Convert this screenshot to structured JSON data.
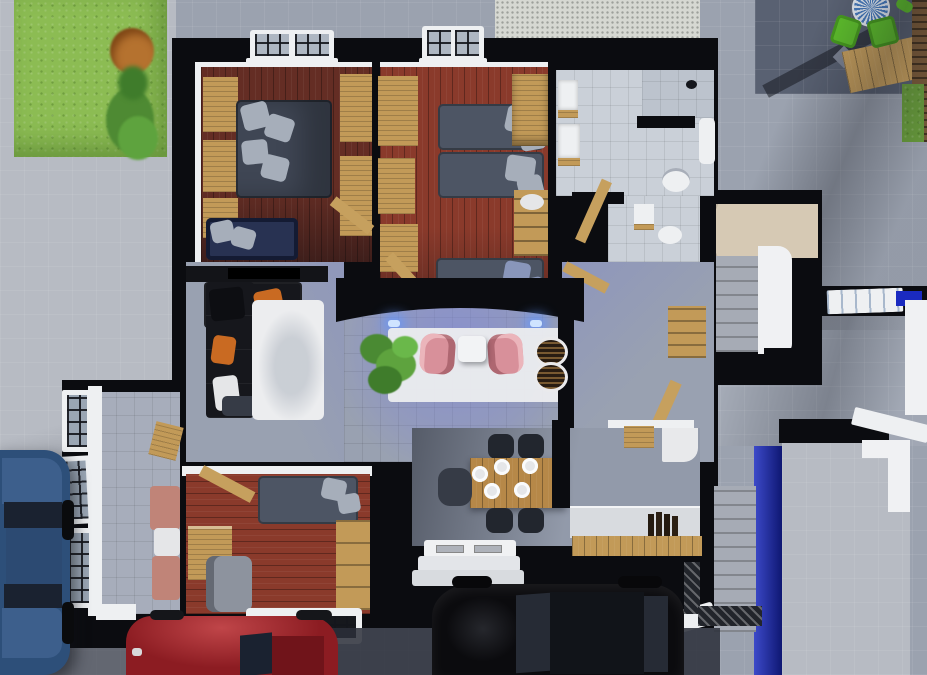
{
  "scene": {
    "kind": "3d-architectural-floor-plan-render",
    "view": "top-down",
    "rooms": [
      "bedroom-top-left",
      "bedroom-top-center",
      "bathroom-main",
      "bathroom-small",
      "hallway",
      "stair-hall",
      "living-room",
      "lounge",
      "sitting-wing",
      "bedroom-bottom",
      "dining-kitchen"
    ],
    "outdoor": [
      "front-lawn",
      "garden-tree",
      "gravel-strip",
      "patio-terrace",
      "wood-deck",
      "driveway",
      "entrance-porch",
      "exterior-stairs",
      "garden-walls"
    ],
    "vehicles": [
      "blue-car",
      "red-car",
      "black-car"
    ]
  },
  "palette": {
    "ground_mid": "#9ba2af",
    "ground_light": "#b7bbc3",
    "patio_dark": "#596172",
    "grass": "#8cbc53",
    "grass_dark": "#699d3c",
    "canopy_orange": "#b5722f",
    "bush_green": "#4e8a33",
    "gravel": "#d6d8d2",
    "wall": "#0b0c10",
    "trim": "#eef0f2",
    "wood_floor_dark": "#642d24",
    "wood_floor_red": "#8a3a2b",
    "wood": "#c29a58",
    "wood_table": "#b68848",
    "door_wood": "#c6a05e",
    "tile_bath": "#cad0d8",
    "tile_shower": "#bcc3cd",
    "tile_room": "#99a1b1",
    "tile_wing": "#a7adbb",
    "tv_wall": "#131418",
    "sofa_black": "#16171c",
    "bed_dark": "#3f4654",
    "bed_mid": "#4d5564",
    "navy_bed": "#283252",
    "pillow_gray": "#a6aeba",
    "pillow_blue": "#8996ba",
    "orange_pillow": "#c96a22",
    "rug_white": "#ecedef",
    "pink_chair": "#d8909a",
    "white_table": "#f2f3f5",
    "plant_green_1": "#4a8a33",
    "plant_green_2": "#5ea33e",
    "plant_green_3": "#3f7c2b",
    "plant_green_4": "#6ab84a",
    "tray_dark": "#281c12",
    "stairs_beige": "#d6c9b4",
    "steps_gray": "#a6abb5",
    "stair_wall_white": "#f0f1f3",
    "counter_gray": "#d8dbdf",
    "unit_white": "#e8e9eb",
    "porch_white": "#f0f1f3",
    "chair_dark": "#22262e",
    "chair_gray": "#363b46",
    "seat_gray": "#8d939e",
    "salmon_sofa": "#c08478",
    "soft_white": "#e5e6e8",
    "blue_wall": "#1a2ac0",
    "car_blue": "#2d4f79",
    "car_blue_hood": "#3d5f8c",
    "car_blue_roof": "#2c4a72",
    "car_glass_dark": "#1a2230",
    "car_red": "#8c1c22",
    "car_red_roof": "#70141a",
    "car_black": "#0b0b0e",
    "car_black_glass": "#262b35",
    "green_chair": "#5fc12c",
    "patio_table_blue": "#4a7ec0",
    "fence_wood": "#7c5c3a",
    "deck_wood": "#c9a15e",
    "shadow_dark": "#2b2f3a"
  }
}
